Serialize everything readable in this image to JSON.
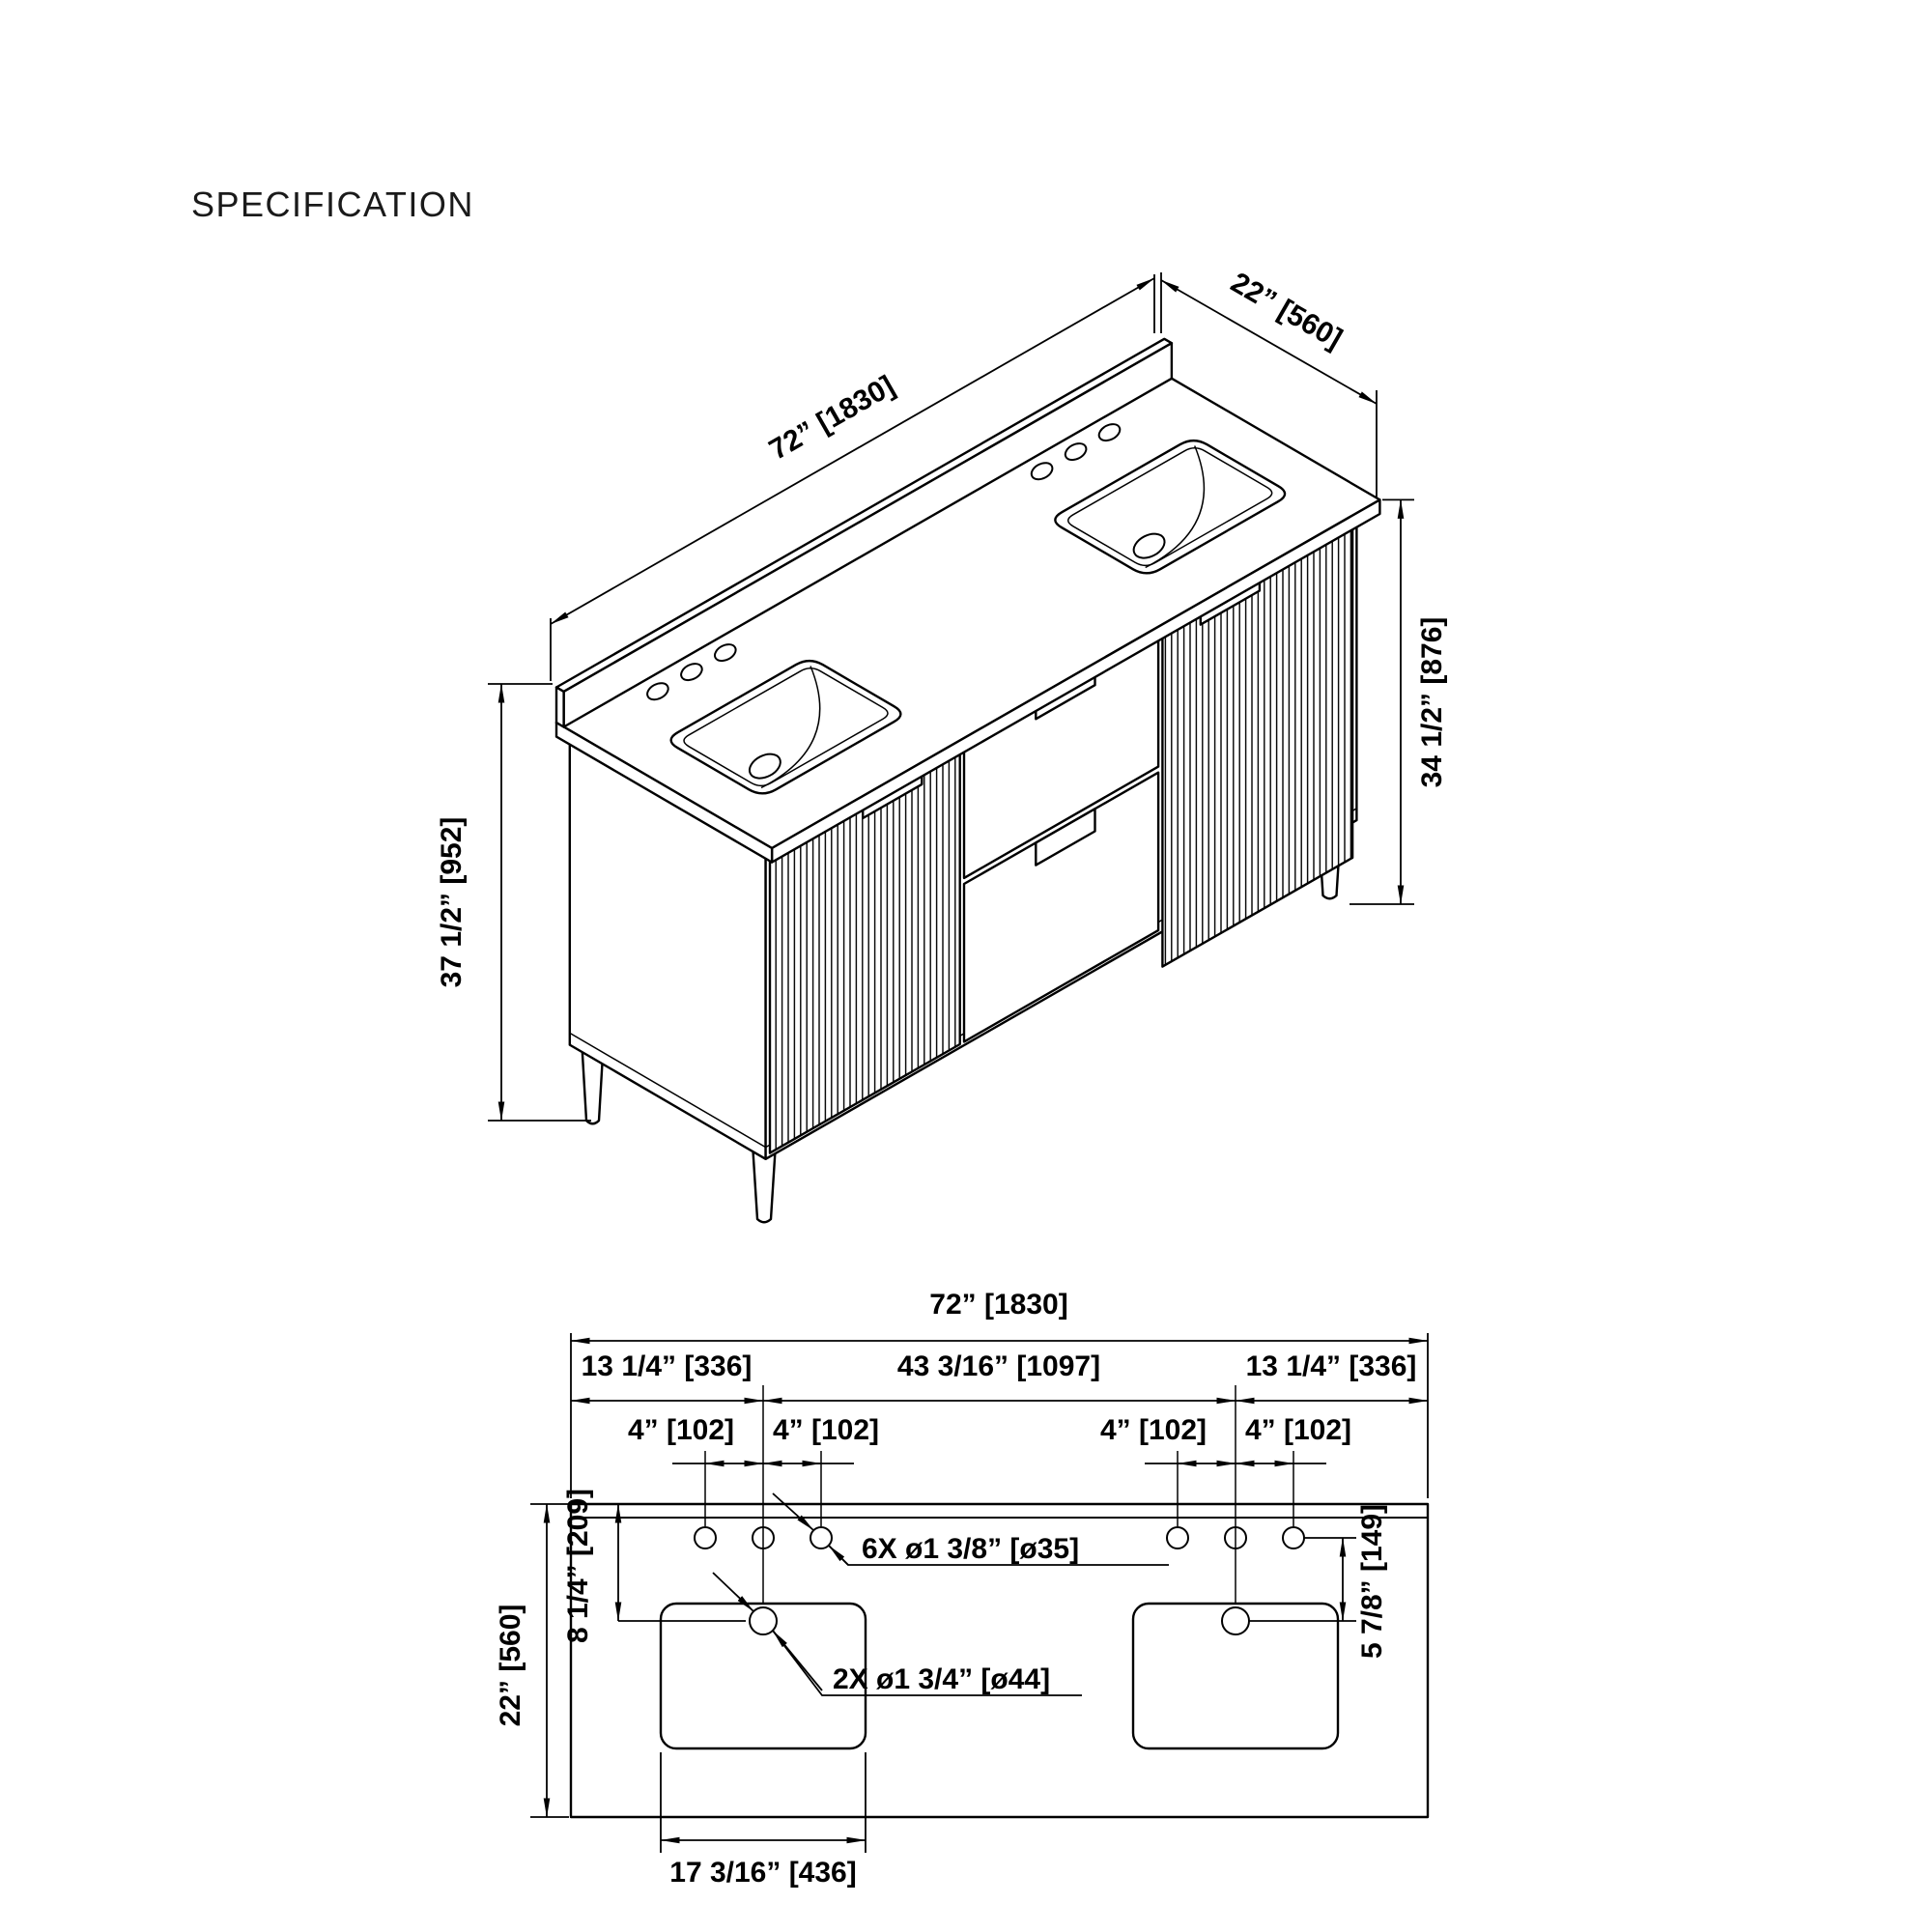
{
  "title": "SPECIFICATION",
  "isometric": {
    "width": "72” [1830]",
    "depth": "22” [560]",
    "counter_height": "34 1/2” [876]",
    "total_height": "37 1/2” [952]"
  },
  "plan": {
    "overall_width": "72” [1830]",
    "left_offset": "13 1/4” [336]",
    "center_span": "43 3/16” [1097]",
    "right_offset": "13 1/4” [336]",
    "hole_spacings": [
      "4” [102]",
      "4” [102]",
      "4” [102]",
      "4” [102]"
    ],
    "depth": "22” [560]",
    "back_to_drain": "8 1/4” [209]",
    "holes_to_drain": "5 7/8” [149]",
    "sink_width": "17 3/16” [436]",
    "faucet_holes_note": "6X ø1 3/8” [ø35]",
    "drain_holes_note": "2X ø1 3/4” [ø44]"
  }
}
